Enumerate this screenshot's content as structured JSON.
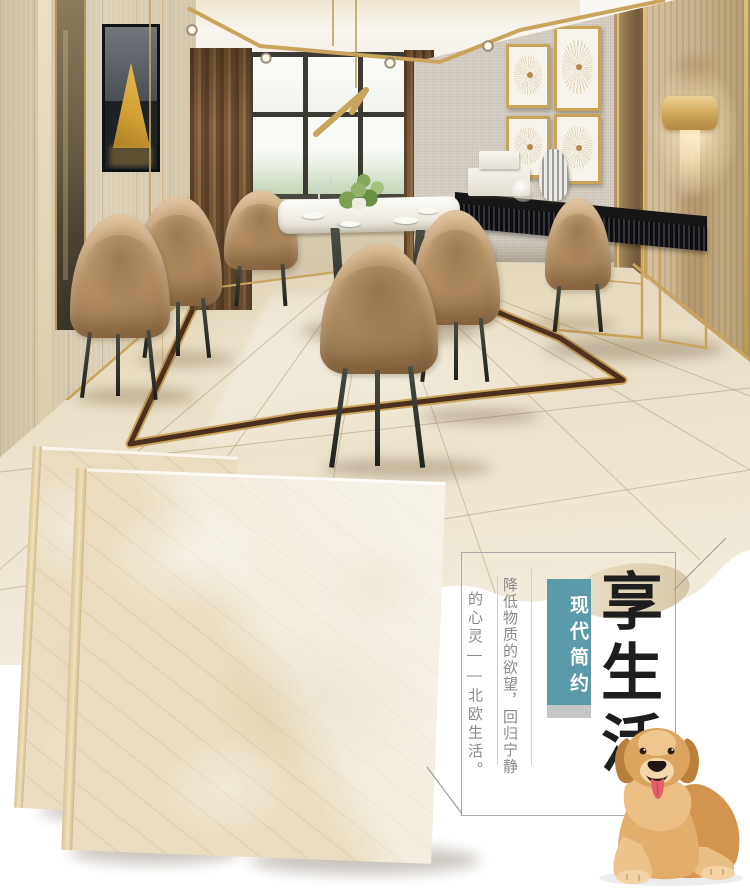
{
  "poster": {
    "slogan": "享生活",
    "badge": "现代简约",
    "tagline_primary": "降低物质的欲望，回归宁静",
    "tagline_secondary": "的心灵——北欧生活。",
    "colors": {
      "badge_teal": "#5b9aa8",
      "badge_bar_gray": "#c4c7c6",
      "slogan_ink": "#1e1e1e",
      "tagline_gray": "#8a8a8a",
      "gold_accent": "#c9a45c",
      "marble_cream": "#e9dcc0",
      "inlay_brown": "#4a2f1d"
    }
  }
}
